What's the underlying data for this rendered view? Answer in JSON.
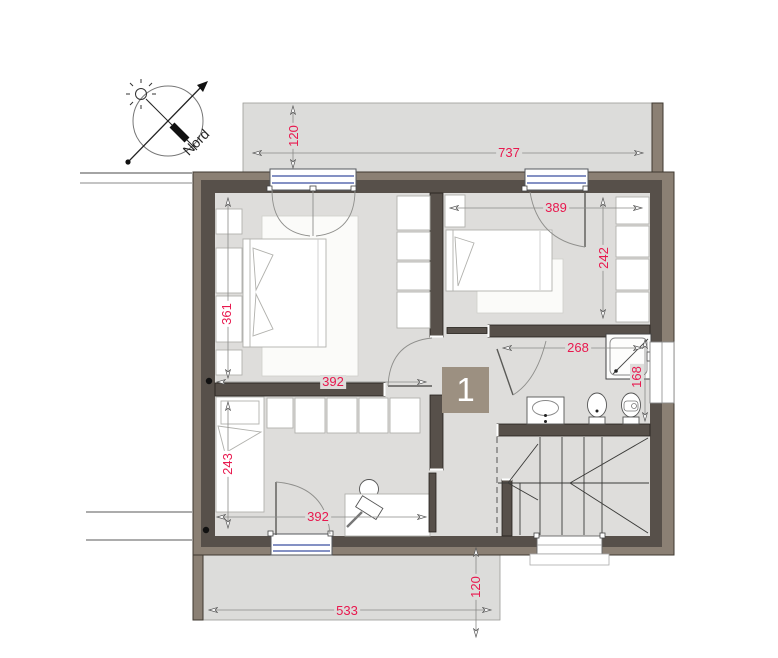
{
  "plan": {
    "floor_marker": "1"
  },
  "compass": {
    "label": "Nord"
  },
  "dimensions": {
    "balcony_depth": "120",
    "overall_width": "737",
    "bedroom2_width": "389",
    "bedroom2_depth": "242",
    "master_depth": "361",
    "master_width": "392",
    "bathroom_width": "268",
    "bathroom_depth": "168",
    "bedroom3_depth": "243",
    "bedroom3_width": "392",
    "terrace_width": "533",
    "terrace_depth": "120"
  },
  "colors": {
    "dim_red": "#e8184e",
    "wall_light": "#8b8074",
    "wall_dark": "#57504a",
    "floor_gray": "#dedddb",
    "terrace_gray": "#dcdcda",
    "window_blue": "#3a4fa0",
    "marker_bg": "#9c9081"
  }
}
